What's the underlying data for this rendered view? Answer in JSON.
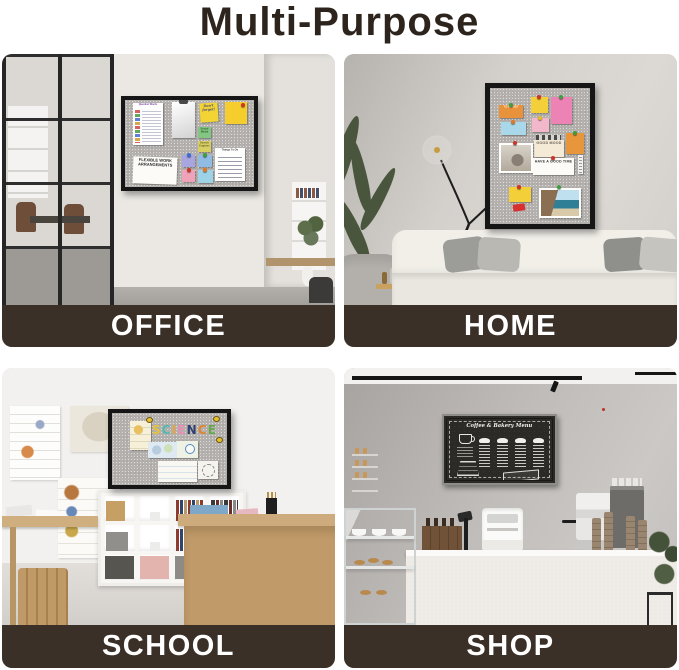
{
  "title": "Multi-Purpose",
  "colors": {
    "background": "#ffffff",
    "title_text": "#2d251d",
    "banner_background": "#3a3027",
    "banner_text": "#ffffff",
    "board_frame": "#161616",
    "board_felt": "#b4b1ae"
  },
  "panels": {
    "office": {
      "label": "OFFICE"
    },
    "home": {
      "label": "HOME"
    },
    "school": {
      "label": "SCHOOL"
    },
    "shop": {
      "label": "SHOP"
    }
  },
  "office_board": {
    "question_words_title": "Question Words",
    "dont_forget_note": "Don't forget!",
    "social_media_note": "Social Media",
    "search_engines_note": "Search Engines",
    "things_to_do_title": "Things To Do",
    "flexible_note": "FLEXIBLE WORK ARRANGEMENTS"
  },
  "home_board": {
    "to_do_list_note": "TO DO LIST",
    "good_mood_note": "GOOD MOOD",
    "have_a_good_time_note": "HAVE A GOOD TIME"
  },
  "school_board": {
    "word": "SCIENCE",
    "letters": [
      "S",
      "C",
      "I",
      "E",
      "N",
      "C",
      "E"
    ],
    "letter_colors": [
      "#e5c23c",
      "#52b8b0",
      "#e8a33c",
      "#e78fb3",
      "#31406f",
      "#df8430",
      "#67a84e"
    ]
  },
  "shop_board": {
    "menu_title": "Coffee & Bakery Menu"
  }
}
